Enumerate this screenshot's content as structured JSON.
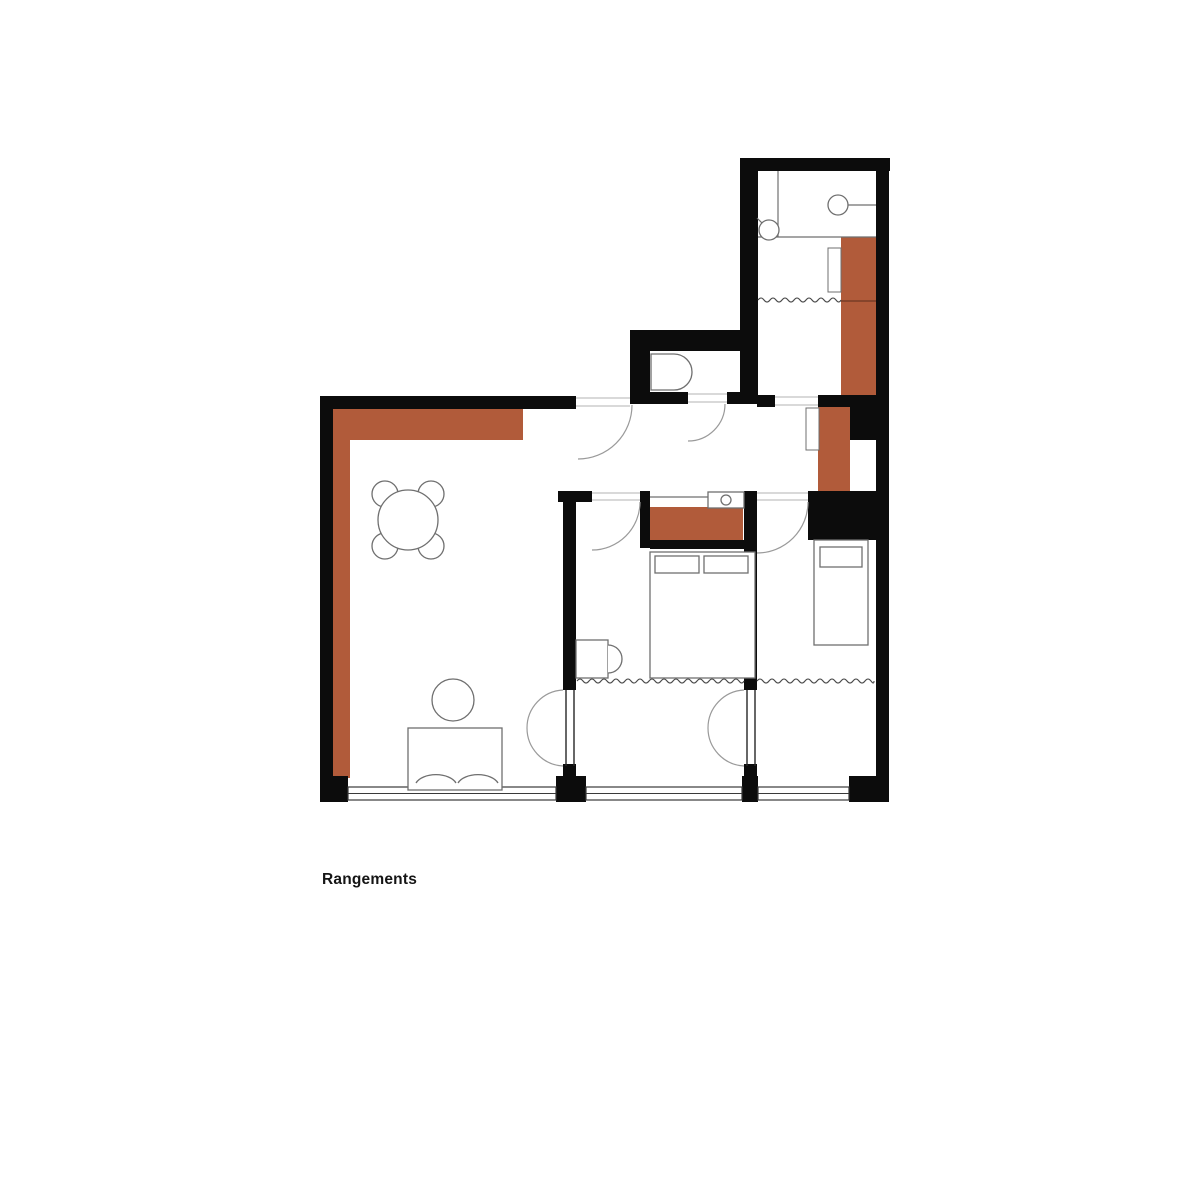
{
  "page": {
    "background": "#ffffff",
    "label": {
      "text": "Rangements"
    }
  },
  "colors": {
    "wall": "#0c0c0c",
    "storage": "#b15b3a",
    "storage_divider": "#6e3723",
    "furniture": "#6f6f6f",
    "door": "#9a9a9a",
    "window": "#3a3a3a",
    "curtain": "#4a4a4a",
    "threshold": "#c2c2c2",
    "partition": "#262626"
  },
  "floorplan": {
    "storage_blocks": [
      {
        "name": "storage-living-top",
        "x": 333,
        "y": 407,
        "w": 190,
        "h": 33
      },
      {
        "name": "storage-living-left",
        "x": 333,
        "y": 440,
        "w": 17,
        "h": 338
      },
      {
        "name": "storage-bath-column",
        "x": 841,
        "y": 237,
        "w": 35,
        "h": 158
      },
      {
        "name": "storage-hall-wardrobe",
        "x": 818,
        "y": 407,
        "w": 32,
        "h": 95
      },
      {
        "name": "storage-bedroom-closet",
        "x": 650,
        "y": 507,
        "w": 93,
        "h": 33
      }
    ],
    "walls": [
      {
        "name": "wall-bath-top",
        "x": 740,
        "y": 158,
        "w": 150,
        "h": 13
      },
      {
        "name": "wall-bath-left",
        "x": 740,
        "y": 158,
        "w": 18,
        "h": 246
      },
      {
        "name": "wall-right",
        "x": 876,
        "y": 158,
        "w": 13,
        "h": 644
      },
      {
        "name": "wall-corner-bottom-right",
        "x": 849,
        "y": 776,
        "w": 40,
        "h": 26
      },
      {
        "name": "wall-wc-top",
        "x": 630,
        "y": 330,
        "w": 128,
        "h": 21
      },
      {
        "name": "wall-wc-left",
        "x": 630,
        "y": 330,
        "w": 20,
        "h": 74
      },
      {
        "name": "wall-living-top",
        "x": 320,
        "y": 396,
        "w": 256,
        "h": 13
      },
      {
        "name": "wall-wc-bottom-a",
        "x": 650,
        "y": 392,
        "w": 38,
        "h": 12
      },
      {
        "name": "wall-wc-bottom-b",
        "x": 727,
        "y": 392,
        "w": 13,
        "h": 12
      },
      {
        "name": "wall-hall-right-a",
        "x": 757,
        "y": 395,
        "w": 18,
        "h": 12
      },
      {
        "name": "wall-hall-right-b",
        "x": 818,
        "y": 395,
        "w": 71,
        "h": 12
      },
      {
        "name": "wall-wardrobe-side",
        "x": 850,
        "y": 407,
        "w": 26,
        "h": 33
      },
      {
        "name": "wall-bedrooms-a",
        "x": 558,
        "y": 491,
        "w": 34,
        "h": 11
      },
      {
        "name": "wall-bedroom1-jamb",
        "x": 640,
        "y": 491,
        "w": 10,
        "h": 57
      },
      {
        "name": "wall-bedroom-divider-top",
        "x": 744,
        "y": 491,
        "w": 13,
        "h": 57
      },
      {
        "name": "wall-bedrooms-b",
        "x": 808,
        "y": 491,
        "w": 81,
        "h": 11
      },
      {
        "name": "wall-closet-bottom",
        "x": 650,
        "y": 540,
        "w": 107,
        "h": 9
      },
      {
        "name": "wall-bedroom2-block",
        "x": 808,
        "y": 502,
        "w": 68,
        "h": 38
      },
      {
        "name": "wall-living-bedroom1",
        "x": 563,
        "y": 491,
        "w": 13,
        "h": 199
      },
      {
        "name": "wall-bedroom1-bedroom2",
        "x": 744,
        "y": 548,
        "w": 13,
        "h": 142
      },
      {
        "name": "wall-left",
        "x": 320,
        "y": 396,
        "w": 13,
        "h": 404
      },
      {
        "name": "wall-corner-bottom-left",
        "x": 320,
        "y": 776,
        "w": 28,
        "h": 26
      },
      {
        "name": "wall-window-pier-a",
        "x": 556,
        "y": 776,
        "w": 30,
        "h": 26
      },
      {
        "name": "wall-window-pier-b",
        "x": 742,
        "y": 776,
        "w": 16,
        "h": 26
      },
      {
        "name": "wall-partition-cap-a",
        "x": 563,
        "y": 764,
        "w": 13,
        "h": 14
      },
      {
        "name": "wall-partition-cap-b",
        "x": 744,
        "y": 764,
        "w": 13,
        "h": 14
      }
    ],
    "cabinet_doors": [
      {
        "name": "cabinet-door-bath",
        "x": 828,
        "y": 248,
        "w": 13,
        "h": 44
      },
      {
        "name": "cabinet-door-wardrobe",
        "x": 806,
        "y": 408,
        "w": 13,
        "h": 42
      }
    ],
    "windows": [
      {
        "name": "window-living",
        "x1": 348,
        "x2": 556,
        "y": 787,
        "h": 13
      },
      {
        "name": "window-bedroom1",
        "x1": 586,
        "x2": 742,
        "y": 787,
        "h": 13
      },
      {
        "name": "window-bedroom2",
        "x1": 758,
        "x2": 849,
        "y": 787,
        "h": 13
      }
    ],
    "curtains": [
      {
        "name": "curtain-bath",
        "x1": 758,
        "x2": 841,
        "y": 300
      },
      {
        "name": "curtain-bedroom1",
        "x1": 577,
        "x2": 744,
        "y": 681
      },
      {
        "name": "curtain-bedroom2",
        "x1": 757,
        "x2": 874,
        "y": 681
      }
    ],
    "thresholds": [
      {
        "name": "threshold-entrance",
        "x1": 576,
        "x2": 630,
        "y1": 398,
        "y2": 406
      },
      {
        "name": "threshold-wc",
        "x1": 688,
        "x2": 727,
        "y1": 394,
        "y2": 402
      },
      {
        "name": "threshold-bedroom1",
        "x1": 592,
        "x2": 640,
        "y1": 493,
        "y2": 500
      },
      {
        "name": "threshold-bedroom2",
        "x1": 757,
        "x2": 808,
        "y1": 493,
        "y2": 500
      },
      {
        "name": "threshold-bath-passage",
        "x1": 775,
        "x2": 818,
        "y1": 397,
        "y2": 405
      }
    ],
    "doors": [
      {
        "name": "door-arc-entrance",
        "d": "M 632 405 A 54 54 0 0 1 578 459"
      },
      {
        "name": "door-arc-wc",
        "d": "M 725 404 A 37 37 0 0 1 688 441"
      },
      {
        "name": "door-arc-bedroom1",
        "d": "M 640 502 A 48 48 0 0 1 592 550"
      },
      {
        "name": "door-arc-bedroom2",
        "d": "M 808 502 A 51 51 0 0 1 757 553"
      },
      {
        "name": "door-arc-swing-a1",
        "d": "M 563 690 A 38 38 0 0 0 527 728"
      },
      {
        "name": "door-arc-swing-a2",
        "d": "M 563 766 A 38 38 0 0 1 527 728"
      },
      {
        "name": "door-arc-swing-b1",
        "d": "M 744 690 A 38 38 0 0 0 708 728"
      },
      {
        "name": "door-arc-swing-b2",
        "d": "M 744 766 A 38 38 0 0 1 708 728"
      }
    ],
    "partition_lines": [
      {
        "name": "partition-living-line1",
        "x1": 566,
        "y1": 690,
        "x2": 566,
        "y2": 766
      },
      {
        "name": "partition-living-line2",
        "x1": 574,
        "y1": 690,
        "x2": 574,
        "y2": 766
      },
      {
        "name": "partition-bedroom-line1",
        "x1": 747,
        "y1": 690,
        "x2": 747,
        "y2": 766
      },
      {
        "name": "partition-bedroom-line2",
        "x1": 755,
        "y1": 690,
        "x2": 755,
        "y2": 766
      }
    ],
    "lines": [
      {
        "name": "bath-partition-vertical",
        "x1": 778,
        "y1": 171,
        "x2": 778,
        "y2": 237
      },
      {
        "name": "bath-partition-horizontal",
        "x1": 758,
        "y1": 237,
        "x2": 876,
        "y2": 237
      },
      {
        "name": "shower-arm",
        "x1": 848,
        "y1": 205,
        "x2": 876,
        "y2": 205
      },
      {
        "name": "shower-valve-handle",
        "x1": 757,
        "y1": 218,
        "x2": 769,
        "y2": 230
      },
      {
        "name": "closet-back-line",
        "x1": 650,
        "y1": 497,
        "x2": 744,
        "y2": 497
      },
      {
        "name": "toilet-tank-line",
        "x1": 674,
        "y1": 354,
        "x2": 674,
        "y2": 390
      },
      {
        "name": "sofa-arm-left",
        "x1": 414,
        "y1": 728,
        "x2": 414,
        "y2": 786
      },
      {
        "name": "sofa-arm-right",
        "x1": 496,
        "y1": 728,
        "x2": 496,
        "y2": 786
      },
      {
        "name": "storage-divider-line",
        "x1": 841,
        "y1": 301,
        "x2": 876,
        "y2": 301,
        "stroke": "storage_divider"
      }
    ],
    "circles": [
      {
        "name": "dining-chair",
        "cx": 385,
        "cy": 494,
        "r": 13
      },
      {
        "name": "dining-chair",
        "cx": 431,
        "cy": 494,
        "r": 13
      },
      {
        "name": "dining-chair",
        "cx": 385,
        "cy": 546,
        "r": 13
      },
      {
        "name": "dining-chair",
        "cx": 431,
        "cy": 546,
        "r": 13
      },
      {
        "name": "dining-table",
        "cx": 408,
        "cy": 520,
        "r": 30
      },
      {
        "name": "side-table",
        "cx": 453,
        "cy": 700,
        "r": 21
      },
      {
        "name": "shower-head",
        "cx": 838,
        "cy": 205,
        "r": 10
      },
      {
        "name": "shower-valve",
        "cx": 769,
        "cy": 230,
        "r": 10
      },
      {
        "name": "counter-sink",
        "cx": 726,
        "cy": 500,
        "r": 5
      }
    ],
    "rects": [
      {
        "name": "sofa",
        "x": 408,
        "y": 728,
        "w": 94,
        "h": 62
      },
      {
        "name": "counter-top",
        "x": 708,
        "y": 492,
        "w": 36,
        "h": 16
      },
      {
        "name": "bed-double",
        "x": 650,
        "y": 552,
        "w": 105,
        "h": 126
      },
      {
        "name": "pillow",
        "x": 655,
        "y": 556,
        "w": 44,
        "h": 17
      },
      {
        "name": "pillow",
        "x": 704,
        "y": 556,
        "w": 44,
        "h": 17
      },
      {
        "name": "washbasin-cabinet",
        "x": 576,
        "y": 640,
        "w": 32,
        "h": 38
      },
      {
        "name": "bed-single",
        "x": 814,
        "y": 540,
        "w": 54,
        "h": 105
      },
      {
        "name": "pillow",
        "x": 820,
        "y": 547,
        "w": 42,
        "h": 20
      }
    ],
    "paths": [
      {
        "name": "toilet",
        "d": "M 651 354 L 674 354 A 18 18 0 0 1 674 390 L 651 390 Z"
      },
      {
        "name": "washbasin-bowl",
        "d": "M 608 645 A 14 14 0 0 1 608 673"
      },
      {
        "name": "sofa-cushion",
        "d": "M 416 783 A 21 12 0 0 1 456 783"
      },
      {
        "name": "sofa-cushion",
        "d": "M 458 783 A 21 12 0 0 1 498 783"
      }
    ]
  }
}
